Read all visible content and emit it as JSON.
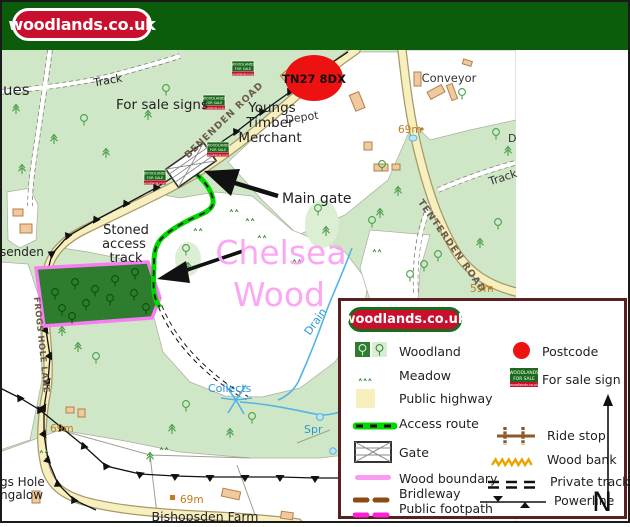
{
  "banner": {
    "logo_text": "woodlands.co.uk"
  },
  "map": {
    "wood_name": {
      "line1": "Chelsea",
      "line2": "Wood"
    },
    "postcode_label": "TN27 8DX",
    "annotations": {
      "for_sale_signs": "For sale signs",
      "main_gate": "Main gate",
      "stoned_l1": "Stoned",
      "stoned_l2": "access",
      "stoned_l3": "track"
    },
    "places": {
      "youngs_l1": "Youngs",
      "youngs_l2": "Timber",
      "youngs_l3": "Merchant",
      "depot": "Depot",
      "conveyor": "Conveyor",
      "bishopsden": "Bishopsden Farm",
      "track_nw": "Track",
      "track_ne": "Track",
      "partial_ues": "ues",
      "partial_senden": "senden",
      "partial_gs_hole": "gs Hole",
      "partial_ngalow": "ngalow",
      "partial_d": "D"
    },
    "roads": {
      "benenden": "BENENDEN ROAD",
      "tenterden": "TENTERDEN ROAD",
      "frogs_hole": "FROGS HOLE LANE"
    },
    "water": {
      "drain": "Drain",
      "collects": "Collects",
      "spring": "Spr"
    },
    "spot_heights": {
      "h69_road": "69m",
      "h59": "59m",
      "h69_lane": "69m",
      "h69_farm": "69m"
    },
    "sale_sign": {
      "l1": "WOODLANDS",
      "l2": "FOR SALE",
      "l3": "woodlands.co.uk"
    }
  },
  "legend": {
    "logo_text": "woodlands.co.uk",
    "left": [
      "Woodland",
      "Meadow",
      "Public highway",
      "Access route",
      "Gate",
      "Wood boundary",
      "Bridleway",
      "Public footpath"
    ],
    "right": [
      "Postcode",
      "For sale sign",
      "Ride stop",
      "Wood bank",
      "Private track",
      "Powerline"
    ],
    "north": "N"
  },
  "colors": {
    "brand_red": "#c8102e",
    "banner_green": "#0b5d0b",
    "map_green": "#cfe7c6",
    "light_green_patch": "#dcefd2",
    "parcel_green": "#2e7d2e",
    "wood_boundary_pink": "#f97df2",
    "wood_name_pink": "#fba7f3",
    "access_route_green": "#00d800",
    "road_yellow": "#f7efbe",
    "building_tan": "#f2c99c",
    "water_blue": "#54b4e6",
    "spot_height_orange": "#bf7d1c",
    "postcode_red": "#ee1111",
    "bridleway_brown": "#8a4b16",
    "footpath_magenta": "#ff1fd4",
    "wood_bank_gold": "#e8a400",
    "ride_stop_brown": "#8a5a2a",
    "legend_border_maroon": "#5a1f1f"
  }
}
